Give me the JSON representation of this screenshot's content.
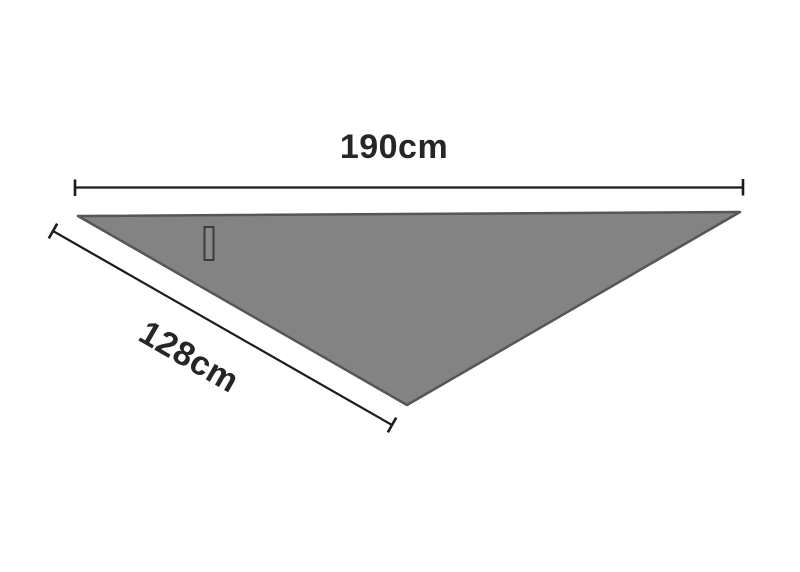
{
  "diagram": {
    "shape": "triangle",
    "top_dimension": {
      "label": "190cm"
    },
    "side_dimension": {
      "label": "128cm"
    },
    "colors": {
      "background": "#ffffff",
      "triangle_fill": "#838383",
      "triangle_stroke": "#565656",
      "dimension_line": "#1b1b1b",
      "label_text": "#262626",
      "tag_fill": "#8a8a8a",
      "tag_stroke": "#3c3c3c"
    }
  }
}
